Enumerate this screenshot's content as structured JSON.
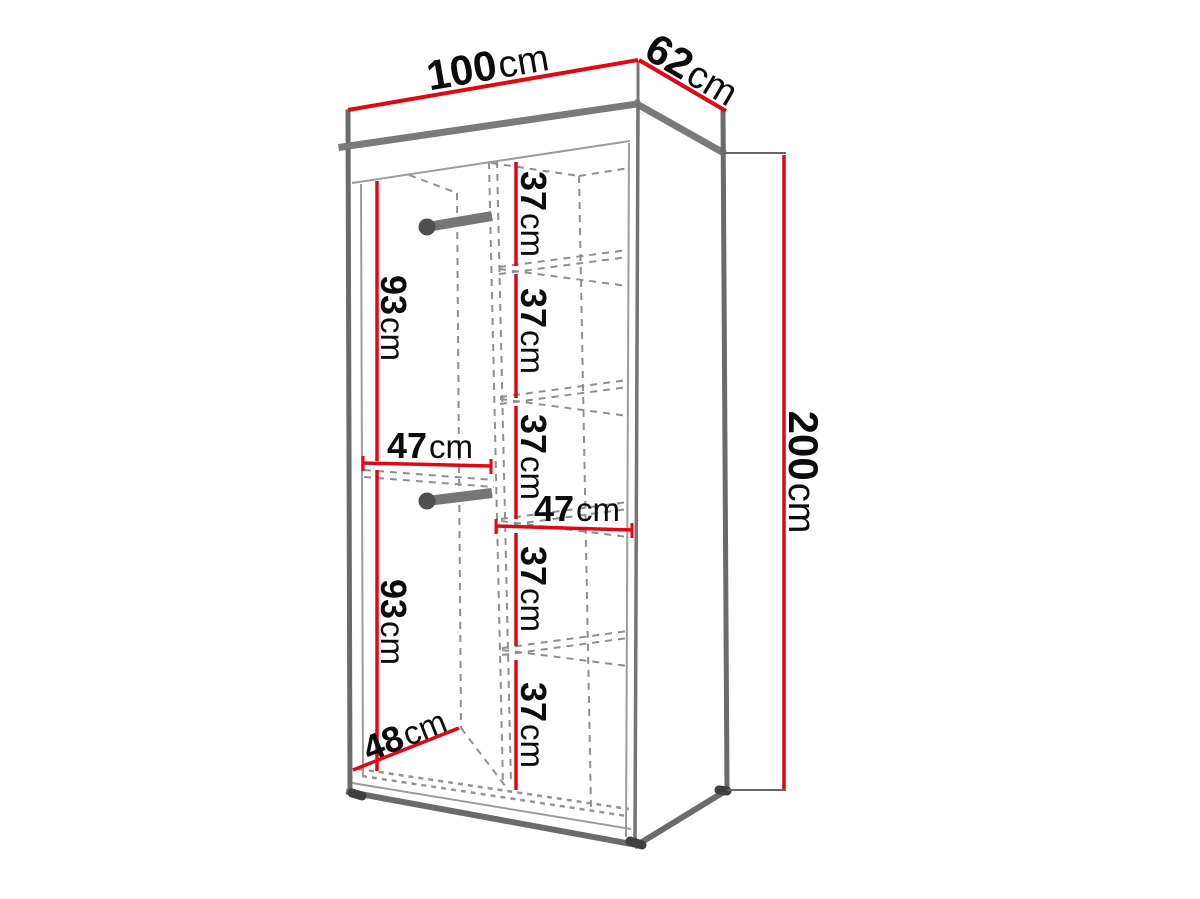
{
  "diagram": {
    "subject": "wardrobe-dimension-diagram",
    "unit": "cm",
    "colors": {
      "dimension_line": "#e30613",
      "outline": "#6b6b6b",
      "dashed_line": "#8f8f8f",
      "text": "#0c0c0c",
      "background": "#ffffff"
    },
    "overall": {
      "width": {
        "num": "100",
        "unit": "cm"
      },
      "depth": {
        "num": "62",
        "unit": "cm"
      },
      "height": {
        "num": "200",
        "unit": "cm"
      }
    },
    "interior": {
      "hanging_sections": [
        {
          "num": "93",
          "unit": "cm"
        },
        {
          "num": "93",
          "unit": "cm"
        }
      ],
      "shelf_spacings": [
        {
          "num": "37",
          "unit": "cm"
        },
        {
          "num": "37",
          "unit": "cm"
        },
        {
          "num": "37",
          "unit": "cm"
        },
        {
          "num": "37",
          "unit": "cm"
        },
        {
          "num": "37",
          "unit": "cm"
        }
      ],
      "section_widths": [
        {
          "num": "47",
          "unit": "cm"
        },
        {
          "num": "47",
          "unit": "cm"
        }
      ],
      "interior_depth": {
        "num": "48",
        "unit": "cm"
      }
    }
  }
}
